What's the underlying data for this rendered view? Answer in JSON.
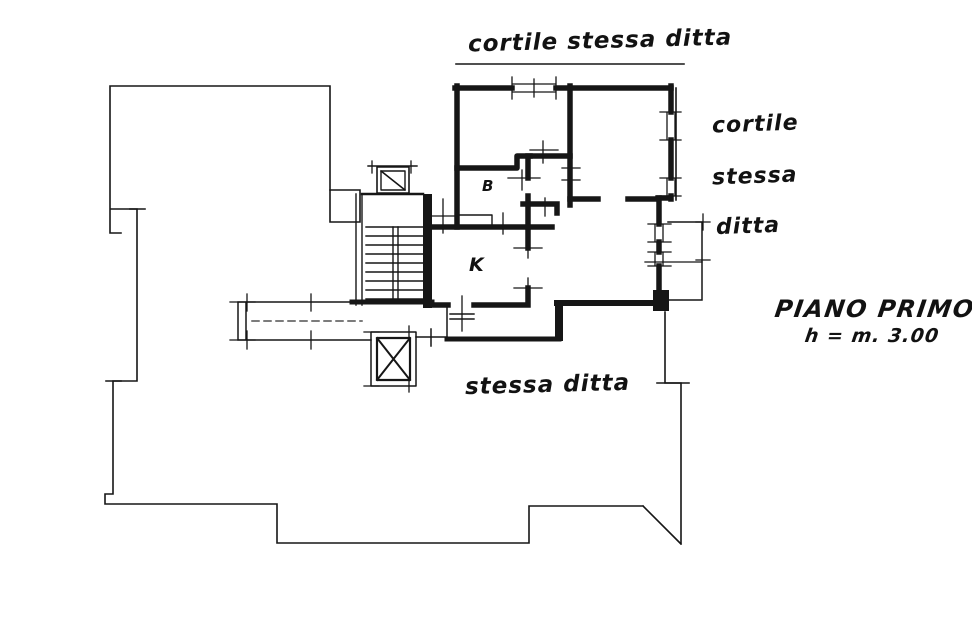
{
  "colors": {
    "ink": "#141414",
    "paper": "#ffffff"
  },
  "labels": {
    "courtyard_top": "cortile stessa ditta",
    "courtyard_right": [
      "cortile",
      "stessa",
      "ditta"
    ],
    "courtyard_bottom": "stessa ditta",
    "floor_name": "PIANO PRIMO",
    "floor_height": "h = m. 3.00",
    "room_b": "B",
    "room_k": "K"
  }
}
